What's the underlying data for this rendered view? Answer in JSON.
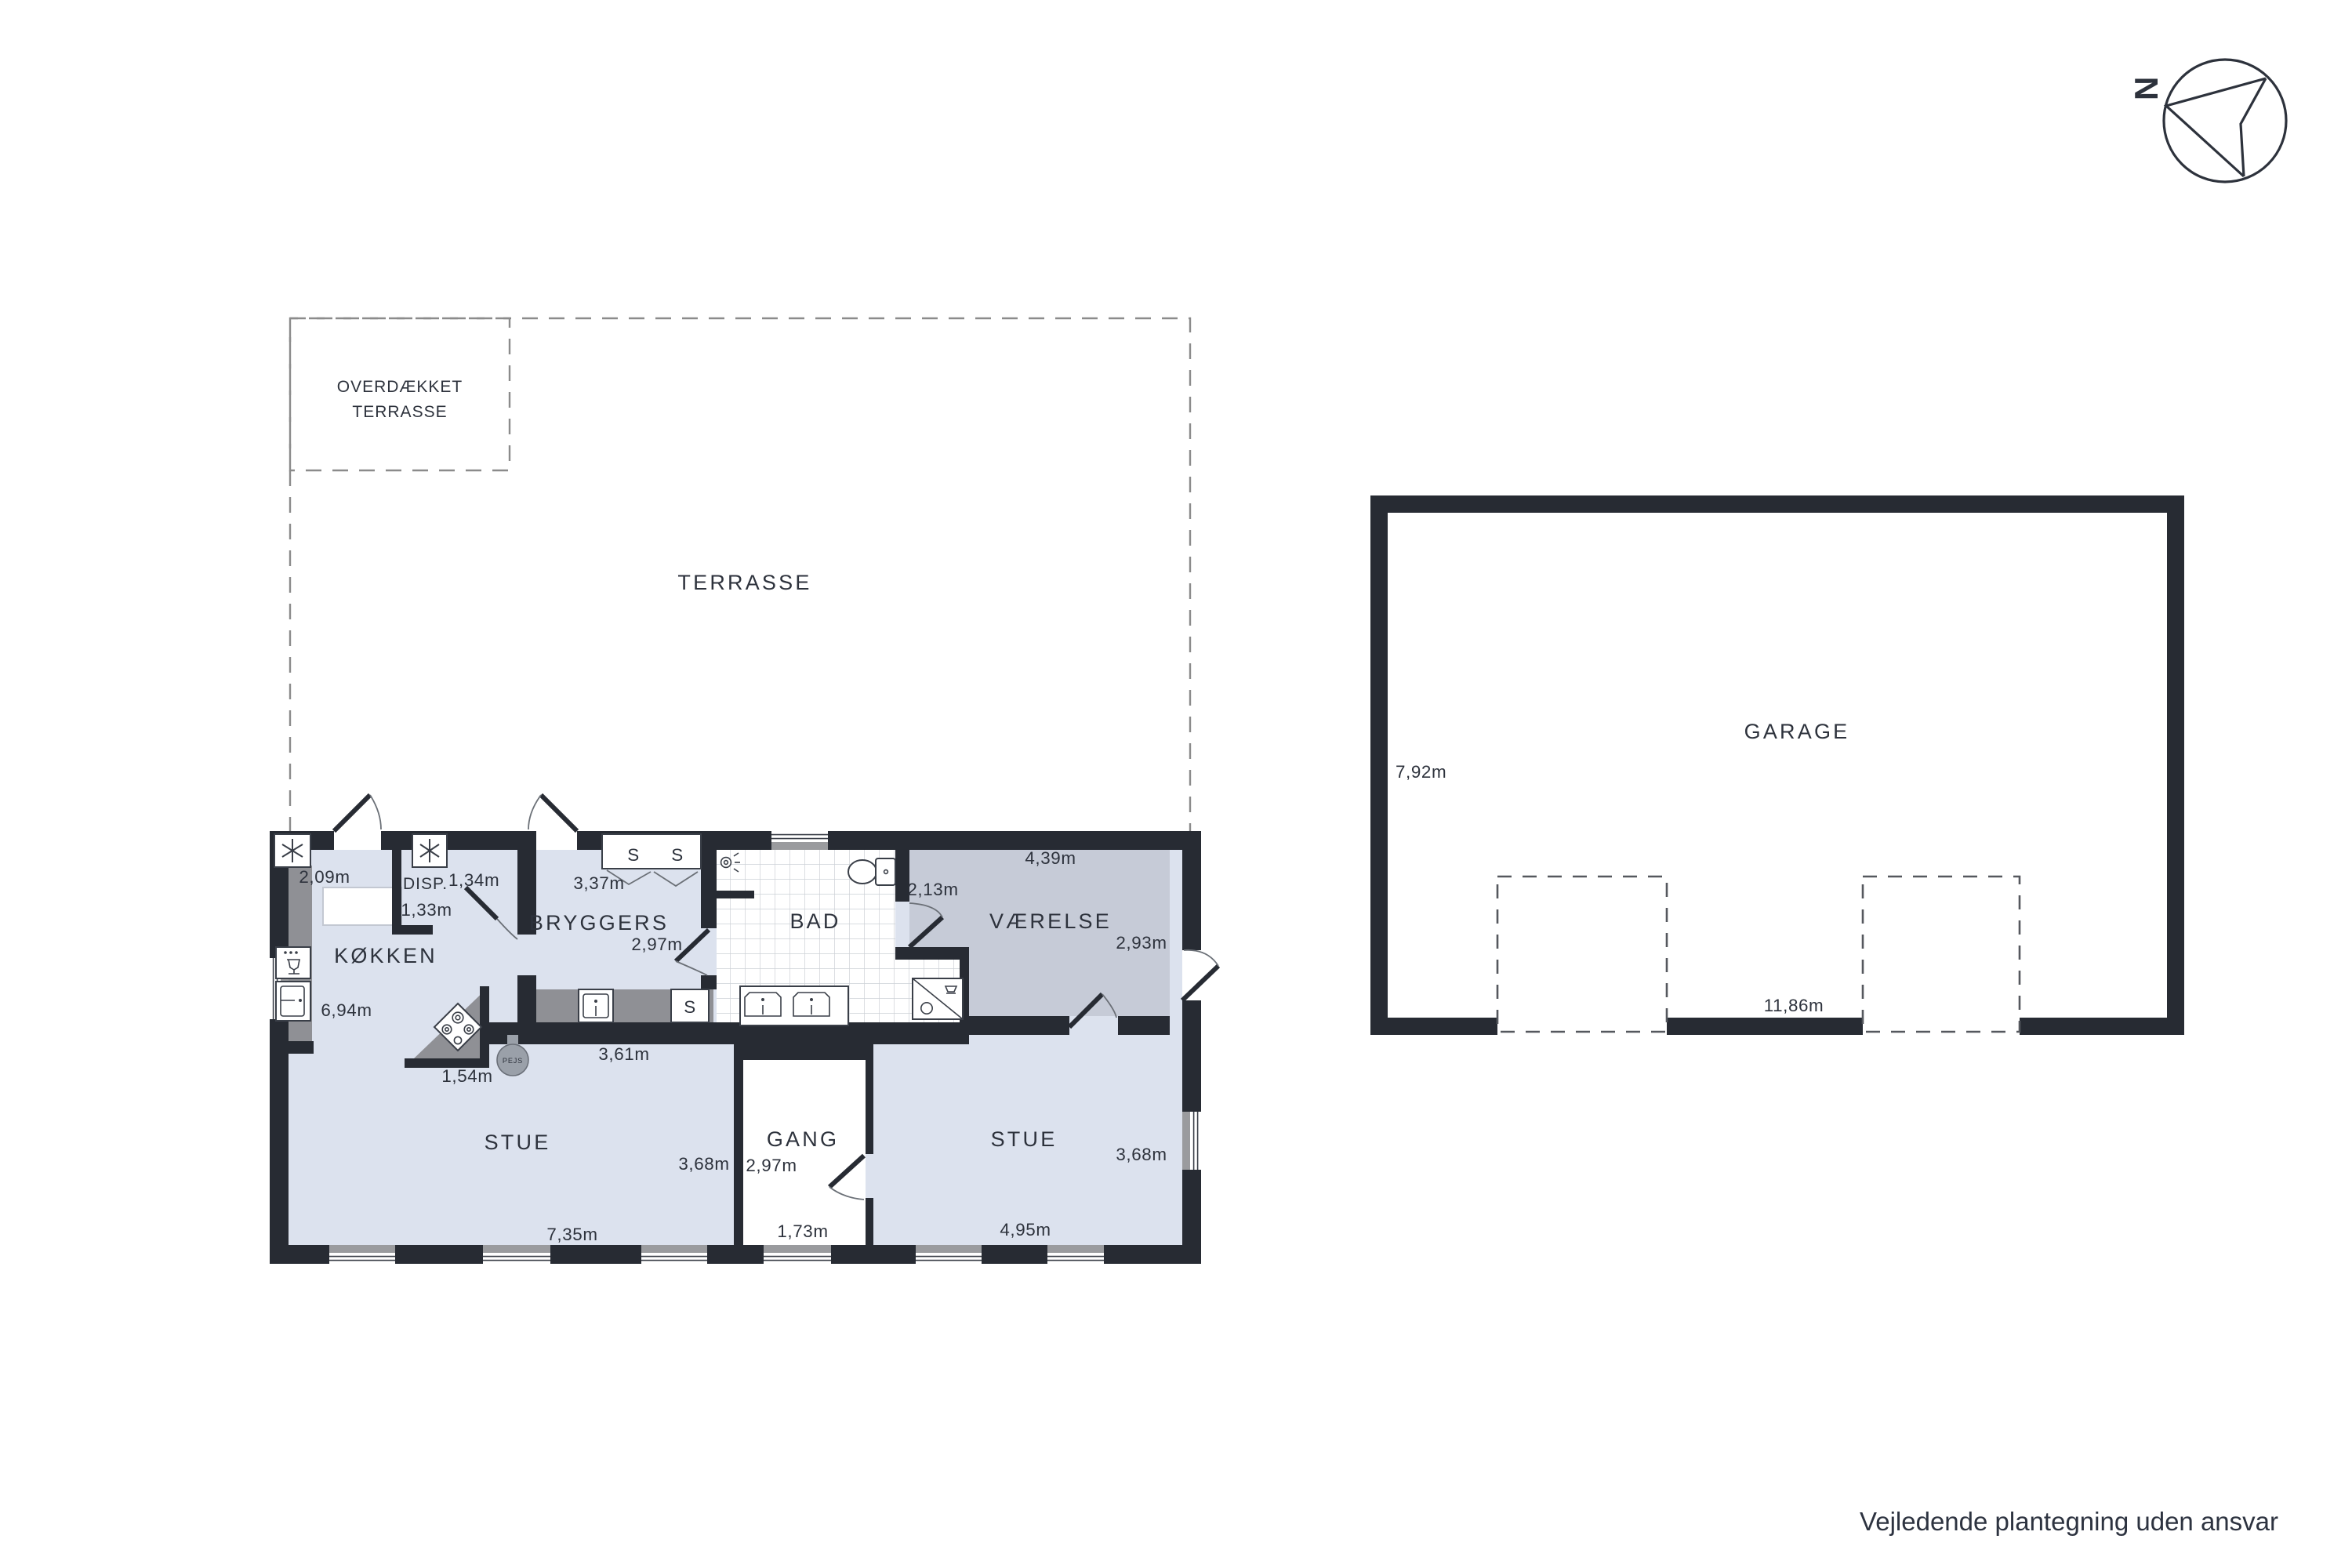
{
  "compass": {
    "label": "N"
  },
  "terrace": {
    "covered_line1": "OVERDÆKKET",
    "covered_line2": "TERRASSE",
    "label": "TERRASSE"
  },
  "rooms": {
    "koekken": {
      "label": "KØKKEN",
      "dim_top": "2,09m",
      "dim_left": "6,94m"
    },
    "disp": {
      "label": "DISP.",
      "dim_right": "1,34m",
      "dim_bottom": "1,33m"
    },
    "bryggers": {
      "label": "BRYGGERS",
      "dim_top": "3,37m",
      "dim_right": "2,97m"
    },
    "bad": {
      "label": "BAD",
      "dim_right": "2,13m"
    },
    "vaerelse": {
      "label": "VÆRELSE",
      "dim_top": "4,39m",
      "dim_right": "2,93m"
    },
    "stue_left": {
      "label": "STUE",
      "dim_bottom": "7,35m",
      "dim_right": "3,68m",
      "dim_counter": "3,61m",
      "dim_stove": "1,54m"
    },
    "gang": {
      "label": "GANG",
      "dim_left": "2,97m",
      "dim_bottom": "1,73m"
    },
    "stue_right": {
      "label": "STUE",
      "dim_bottom": "4,95m",
      "dim_right": "3,68m"
    }
  },
  "fixtures": {
    "closet_s1": "S",
    "closet_s2": "S",
    "cabinet_s": "S",
    "fireplace": "PEJS"
  },
  "garage": {
    "label": "GARAGE",
    "dim_left": "7,92m",
    "dim_bottom": "11,86m"
  },
  "footer": {
    "disclaimer": "Vejledende plantegning uden ansvar"
  },
  "colors": {
    "wall": "#272b33",
    "room_light": "#dce2ee",
    "room_gray": "#c6cbd7",
    "counter_gray": "#8f9095",
    "tile_line": "#ccd0d6",
    "dashed_line": "#8b8b8b",
    "text": "#2d323c"
  }
}
